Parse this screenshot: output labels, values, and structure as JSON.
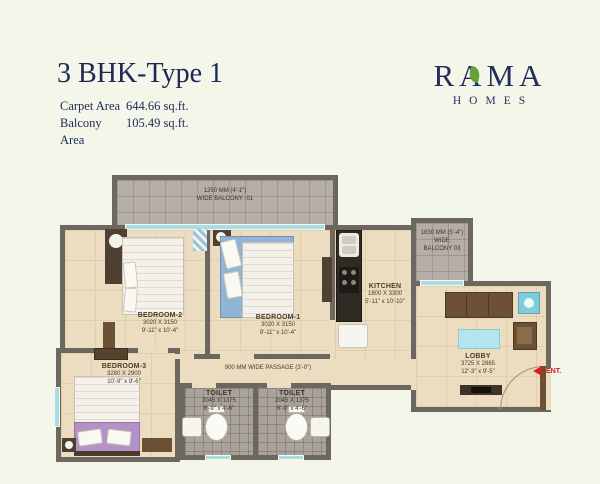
{
  "header": {
    "title": "3 BHK-Type 1",
    "carpet_label": "Carpet Area",
    "carpet_value": "644.66 sq.ft.",
    "balcony_label": "Balcony Area",
    "balcony_value": "105.49 sq.ft."
  },
  "logo": {
    "brand": "RAMA",
    "sub": "HOMES"
  },
  "colors": {
    "navy": "#232e5c",
    "leaf_green": "#63a139",
    "entry_red": "#cf1f1f",
    "wall": "#6c675f",
    "window_teal": "#a8dde4"
  },
  "plan": {
    "balcony01": {
      "line1": "1250 MM (4'-1\")",
      "line2": "WIDE BALCONY -01"
    },
    "balcony03": {
      "line1": "1630 MM (5'-4\")",
      "line2": "WIDE",
      "line3": "BALCONY 03"
    },
    "bedroom2": {
      "name": "BEDROOM-2",
      "mm": "3020 X 3150",
      "ft": "9'-11\" x 10'-4\""
    },
    "bedroom1": {
      "name": "BEDROOM-1",
      "mm": "3020 X 3150",
      "ft": "9'-11\" x 10'-4\""
    },
    "bedroom3": {
      "name": "BEDROOM-3",
      "mm": "3280 X 2900",
      "ft": "10'-9\" x 9'-6\""
    },
    "kitchen": {
      "name": "KITCHEN",
      "mm": "1800 X 3300",
      "ft": "5'-11\" x 10'-10\""
    },
    "lobby": {
      "name": "LOBBY",
      "mm": "3725 X 2865",
      "ft": "12'-3\" x 9'-5\""
    },
    "toilet": {
      "name": "TOILET",
      "mm": "2045 X 1375",
      "ft": "6'-9\" x 4'-6\""
    },
    "passage": {
      "label": "900 MM WIDE PASSAGE (3'-0\")"
    },
    "entry": {
      "label": "ENT."
    }
  }
}
